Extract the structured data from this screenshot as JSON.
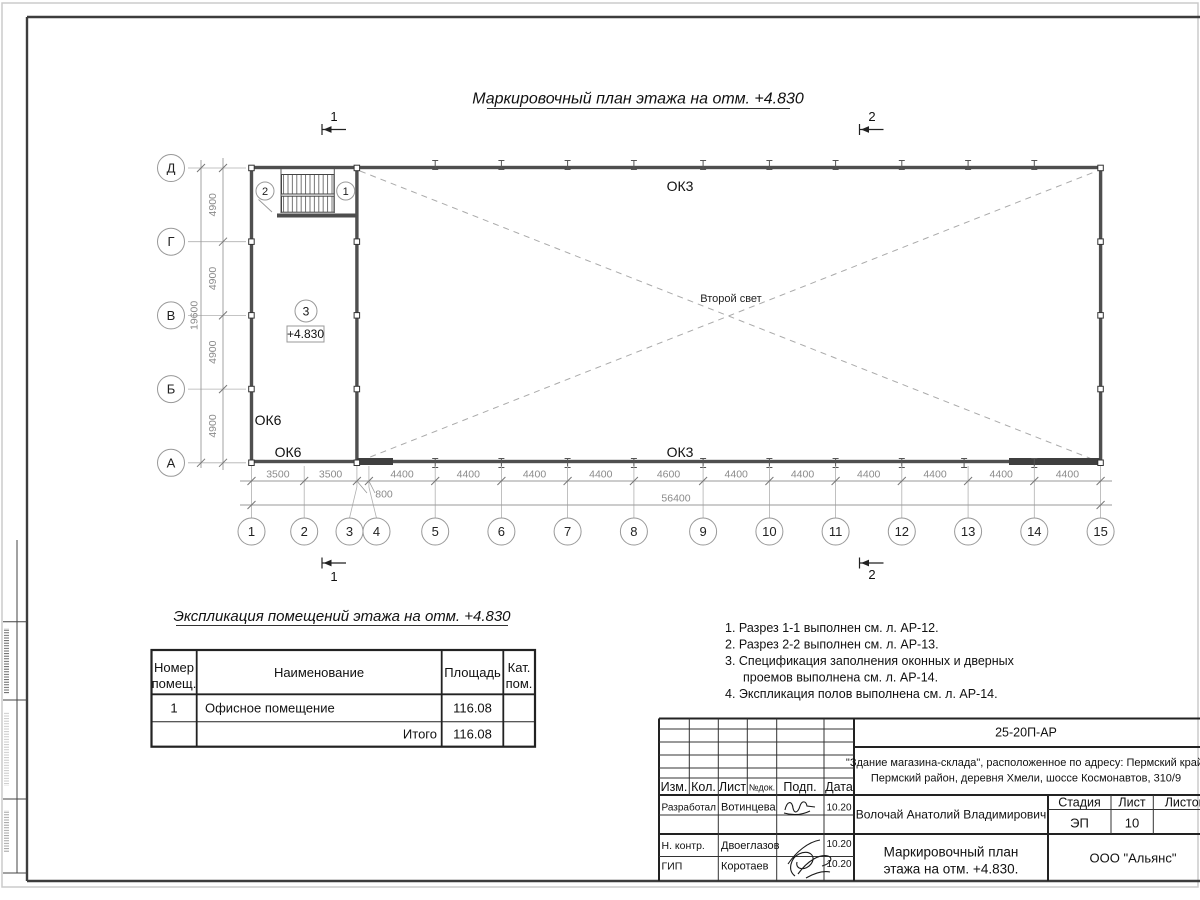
{
  "titles": {
    "plan": "Маркировочный план этажа на отм. +4.830",
    "explication": "Экспликация помещений этажа на отм. +4.830"
  },
  "plan": {
    "axes_letters": [
      "Д",
      "Г",
      "В",
      "Б",
      "А"
    ],
    "axes_numbers": [
      "1",
      "2",
      "3",
      "4",
      "5",
      "6",
      "7",
      "8",
      "9",
      "10",
      "11",
      "12",
      "13",
      "14",
      "15"
    ],
    "dims_left": [
      "4900",
      "4900",
      "4900",
      "4900"
    ],
    "total_left": "19600",
    "dims_bottom": [
      "3500",
      "3500",
      "4400",
      "4400",
      "4400",
      "4400",
      "4600",
      "4400",
      "4400",
      "4400",
      "4400",
      "4400",
      "4400"
    ],
    "dim_small": "800",
    "total_bottom": "56400",
    "labels": {
      "ok3_top": "ОК3",
      "ok3_bottom": "ОК3",
      "ok6_upper": "ОК6",
      "ok6_lower": "ОК6",
      "second_light": "Второй свет",
      "level": "+4.830",
      "room_bubble": "3",
      "stair_bubble_left": "2",
      "stair_bubble_right": "1"
    },
    "sections": {
      "s1": "1",
      "s2": "2"
    }
  },
  "explication": {
    "headers": {
      "num1": "Номер",
      "num2": "помещ.",
      "name": "Наименование",
      "area": "Площадь",
      "cat1": "Кат.",
      "cat2": "пом."
    },
    "rows": [
      {
        "num": "1",
        "name": "Офисное помещение",
        "area": "116.08",
        "cat": ""
      }
    ],
    "total_label": "Итого",
    "total_area": "116.08"
  },
  "notes": [
    "1. Разрез 1-1 выполнен см. л. АР-12.",
    "2. Разрез 2-2 выполнен см. л. АР-13.",
    "3. Спецификация заполнения оконных и дверных",
    "проемов выполнена см. л. АР-14.",
    "4. Экспликация полов выполнена см. л. АР-14."
  ],
  "title_block": {
    "doc_code": "25-20П-АР",
    "address_line1": "\"Здание магазина-склада\", расположенное по адресу: Пермский край,",
    "address_line2": "Пермский район, деревня Хмели, шоссе Космонавтов, 310/9",
    "cols": {
      "izm": "Изм.",
      "kol": "Кол.",
      "list": "Лист",
      "ndok": "№док.",
      "podp": "Подп.",
      "data": "Дата"
    },
    "rows": [
      {
        "role": "Разработал",
        "name": "Вотинцева",
        "date": "10.20"
      },
      {
        "role": "Н. контр.",
        "name": "Двоеглазов",
        "date": "10.20"
      },
      {
        "role": "ГИП",
        "name": "Коротаев",
        "date": "10.20"
      }
    ],
    "chief": "Волочай Анатолий Владимирович",
    "stage_label": "Стадия",
    "sheet_label": "Лист",
    "sheets_label": "Листов",
    "stage": "ЭП",
    "sheet": "10",
    "drawing_title_line1": "Маркировочный план",
    "drawing_title_line2": "этажа на отм. +4.830.",
    "company": "ООО \"Альянс\""
  }
}
